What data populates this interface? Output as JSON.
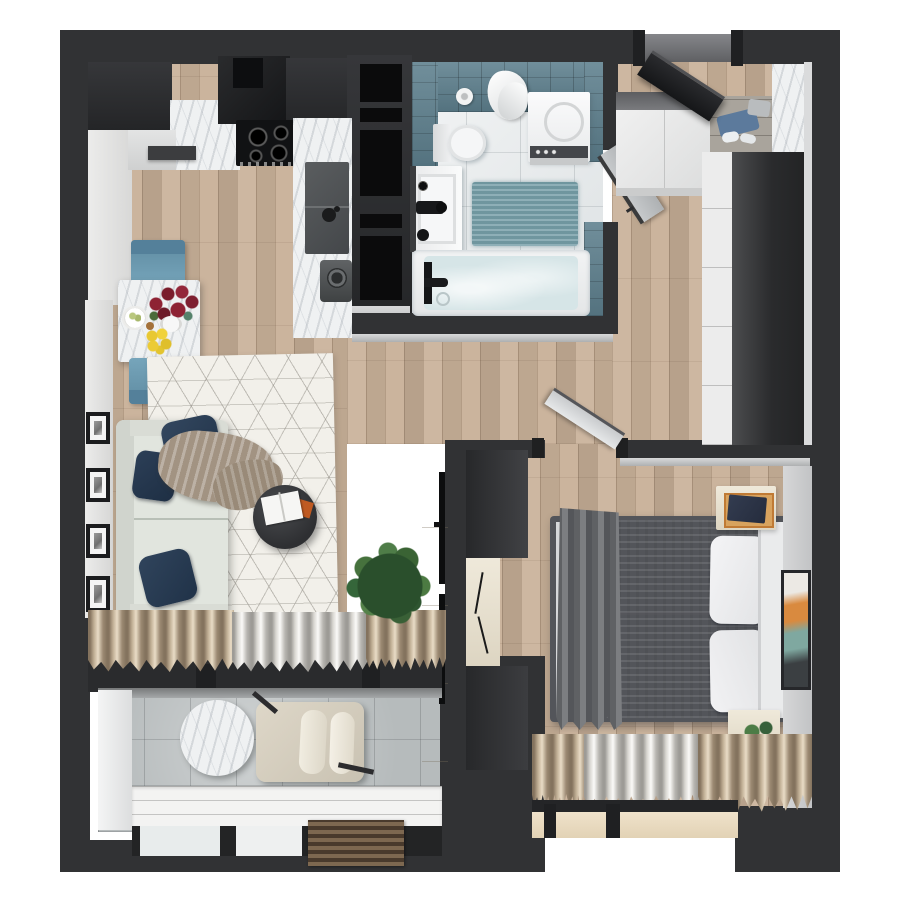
{
  "scene": {
    "kind": "3d-top-down-apartment-floor-plan-render",
    "background": "#ffffff",
    "text_visible": false,
    "palette": {
      "outer_wall": "#313234",
      "dark_cabinet": "#2b2c2e",
      "wood_floor": "#c9b199",
      "bathroom_tile_teal": "#5d7f8d",
      "bathroom_floor": "#e7eaeb",
      "balcony_floor": "#b6bbbc",
      "marble": "#eff1f2",
      "rug_white": "#f2f0ea",
      "sofa_sage": "#e1e5de",
      "pillow_navy": "#2a3c54",
      "throw_taupe": "#a29382",
      "chair_blue": "#6d9cb3",
      "tulip_red": "#8e2233",
      "lemon_yellow": "#e8c832",
      "duvet_grey": "#bcbdc0",
      "bed_throw_grey": "#6e7073",
      "pillow_white": "#f1f1f3",
      "curtain_taupe": "#b0a08c",
      "curtain_white": "#e9e7e2",
      "nightstand_cream": "#e9e3d3",
      "plant_green": "#46723d",
      "sill_beige": "#e9dac1"
    },
    "rooms": [
      {
        "name": "kitchen-living-room",
        "items": [
          "dark-upper-cabinets",
          "range-hood",
          "cooktop",
          "marble-counter",
          "sink-peninsula",
          "coffee-machine",
          "tall-black-cabinet-column",
          "dining-table",
          "blue-chair-top",
          "blue-chair-bottom",
          "tulip-bouquet",
          "lemon-bowl",
          "snack-plate",
          "wall-frames",
          "sofa",
          "navy-pillows",
          "taupe-throw",
          "geometric-rug",
          "round-coffee-table",
          "open-book",
          "potted-plant",
          "tv-console",
          "wall-tv",
          "window-curtains"
        ]
      },
      {
        "name": "bathroom",
        "items": [
          "teal-wall-tiles",
          "toilet",
          "toilet-paper-roll",
          "hanging-towel",
          "washing-machine",
          "bath-mat",
          "vanity-sink",
          "black-faucet",
          "bathtub",
          "tub-faucet",
          "bathroom-door"
        ]
      },
      {
        "name": "entry-hall",
        "items": [
          "entry-door",
          "white-cabinets",
          "open-shoe-shelf",
          "marble-panel",
          "white-wardrobe",
          "dark-wardrobe"
        ]
      },
      {
        "name": "bedroom",
        "items": [
          "bedroom-door",
          "double-bed",
          "grey-duvet",
          "white-pillows",
          "dark-throw",
          "headboard",
          "nightstand-with-clothes",
          "nightstand-with-plant",
          "wall-artwork",
          "bedroom-wardrobe",
          "window-curtains",
          "window-sill"
        ]
      },
      {
        "name": "balcony",
        "items": [
          "round-marble-table",
          "lounge-chair",
          "white-ledge",
          "wood-slat-grate",
          "glazing"
        ]
      }
    ]
  }
}
